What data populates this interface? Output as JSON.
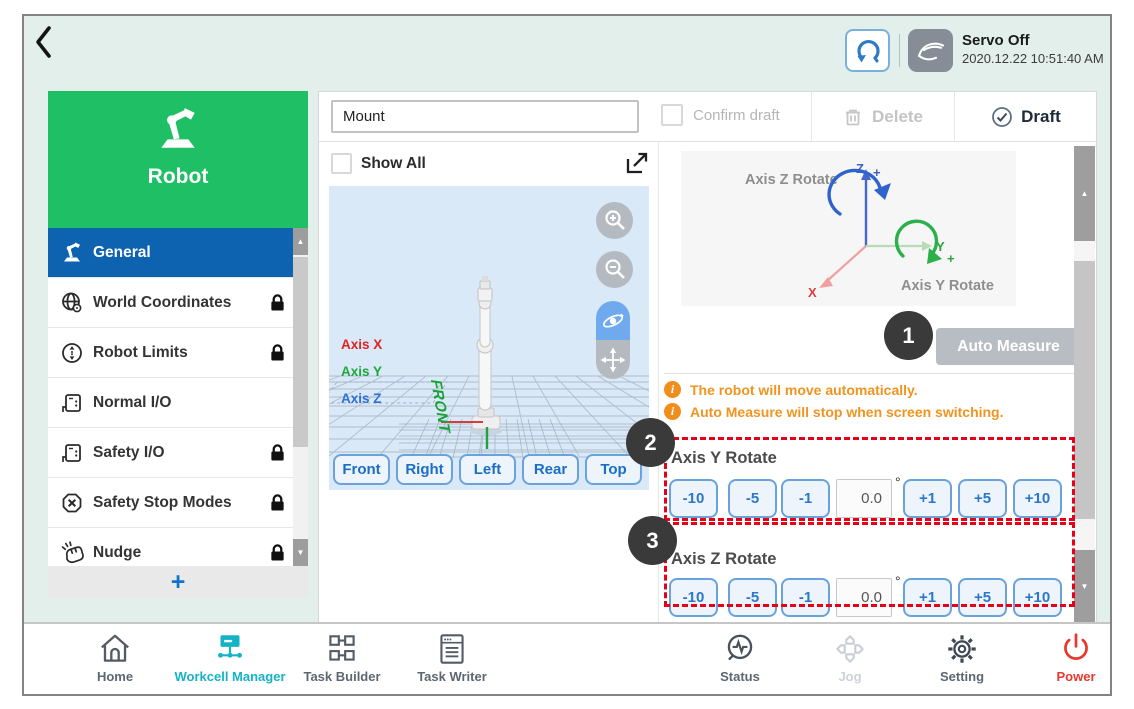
{
  "header": {
    "servo_status": "Servo Off",
    "datetime": "2020.12.22 10:51:40 AM"
  },
  "sidebar": {
    "title": "Robot",
    "items": [
      {
        "label": "General",
        "locked": false,
        "selected": true
      },
      {
        "label": "World Coordinates",
        "locked": true,
        "selected": false
      },
      {
        "label": "Robot Limits",
        "locked": true,
        "selected": false
      },
      {
        "label": "Normal I/O",
        "locked": false,
        "selected": false
      },
      {
        "label": "Safety I/O",
        "locked": true,
        "selected": false
      },
      {
        "label": "Safety Stop Modes",
        "locked": true,
        "selected": false
      },
      {
        "label": "Nudge",
        "locked": true,
        "selected": false
      }
    ],
    "add_button": "+"
  },
  "toolbar": {
    "name_field_value": "Mount",
    "confirm_draft_label": "Confirm draft",
    "delete_label": "Delete",
    "draft_label": "Draft"
  },
  "viewer": {
    "show_all_label": "Show All",
    "axis_x": "Axis X",
    "axis_y": "Axis Y",
    "axis_z": "Axis Z",
    "floor_label": "FRONT",
    "view_buttons": [
      "Front",
      "Right",
      "Left",
      "Rear",
      "Top"
    ]
  },
  "measure": {
    "diagram": {
      "z_rotate_label": "Axis Z Rotate",
      "y_rotate_label": "Axis Y Rotate",
      "z_axis": "Z",
      "y_axis": "Y",
      "x_axis": "X",
      "plus": "+"
    },
    "auto_measure_label": "Auto Measure",
    "notes": [
      "The robot will move automatically.",
      "Auto Measure will stop when screen switching."
    ],
    "callouts": [
      "1",
      "2",
      "3"
    ],
    "sections": [
      {
        "title": "Axis Y Rotate",
        "dec": [
          "-10",
          "-5",
          "-1"
        ],
        "value": "0.0",
        "unit": "°",
        "inc": [
          "+1",
          "+5",
          "+10"
        ]
      },
      {
        "title": "Axis Z Rotate",
        "dec": [
          "-10",
          "-5",
          "-1"
        ],
        "value": "0.0",
        "unit": "°",
        "inc": [
          "+1",
          "+5",
          "+10"
        ]
      }
    ]
  },
  "glyphs": {
    "scroll_up": "▲",
    "scroll_down": "▼",
    "info": "i"
  },
  "bottom_nav": {
    "items": [
      {
        "label": "Home",
        "state": "normal"
      },
      {
        "label": "Workcell Manager",
        "state": "active"
      },
      {
        "label": "Task Builder",
        "state": "normal"
      },
      {
        "label": "Task Writer",
        "state": "normal"
      },
      {
        "label": "Status",
        "state": "normal"
      },
      {
        "label": "Jog",
        "state": "disabled"
      },
      {
        "label": "Setting",
        "state": "normal"
      },
      {
        "label": "Power",
        "state": "danger"
      }
    ]
  },
  "colors": {
    "background_mint": "#e2efeb",
    "brand_green": "#1fbf66",
    "selected_blue": "#0e63b0",
    "control_blue": "#2c77c9",
    "active_teal": "#14b4c6",
    "warning_orange": "#ef8e1d",
    "annotation_red": "#e60018",
    "power_red": "#e8392f"
  }
}
